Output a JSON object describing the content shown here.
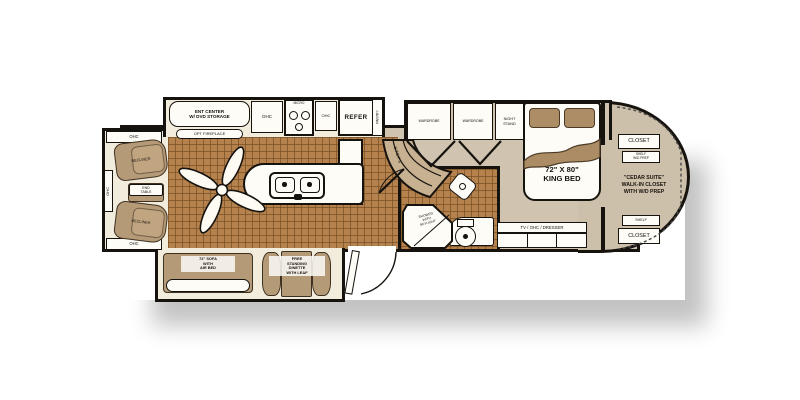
{
  "living": {
    "ohc_top": "OHC",
    "ohc_side": "OHC",
    "ohc_bottom": "OHC",
    "recliner_1": "RECLINER",
    "recliner_2": "RECLINER",
    "end_table": "END\nTABLE",
    "ent_center": "ENT CENTER\nW/ DVD STORAGE",
    "opt_fireplace": "OPT FIREPLACE",
    "sofa": "72\" SOFA\nWITH\nAIR BED",
    "dinette": "FREE\nSTANDING\nDINETTE\nWITH LEAF"
  },
  "kitchen": {
    "ohc_left": "OHC",
    "micro": "MICRO",
    "ohc_right": "OHC",
    "refer": "REFER",
    "pantry": "PANTRY",
    "steps": "STEPS"
  },
  "bath": {
    "shower": "SHOWER\nWITH\nSKYLIGHT"
  },
  "bedroom": {
    "wardrobe_1": "WARDROBE",
    "wardrobe_2": "WARDROBE",
    "night_stand": "NIGHT\nSTAND",
    "king_bed": "72\" X 80\"\nKING BED",
    "tv_dresser": "TV / OHC / DRESSER"
  },
  "closet": {
    "closet_top": "CLOSET",
    "shelf_top": "SHELF\nW/D PREP",
    "walk_in": "\"CEDAR SUITE\"\nWALK-IN CLOSET\nWITH W/D PREP",
    "shelf_bottom": "SHELF",
    "closet_bottom": "CLOSET"
  },
  "colors": {
    "wall": "#16120e",
    "carpet": "#d0c4b0",
    "tile": "#b5824e",
    "furniture_tan": "#b59a77",
    "cabinet_white": "#fdfcf7",
    "steps_tan": "#c7b191"
  }
}
